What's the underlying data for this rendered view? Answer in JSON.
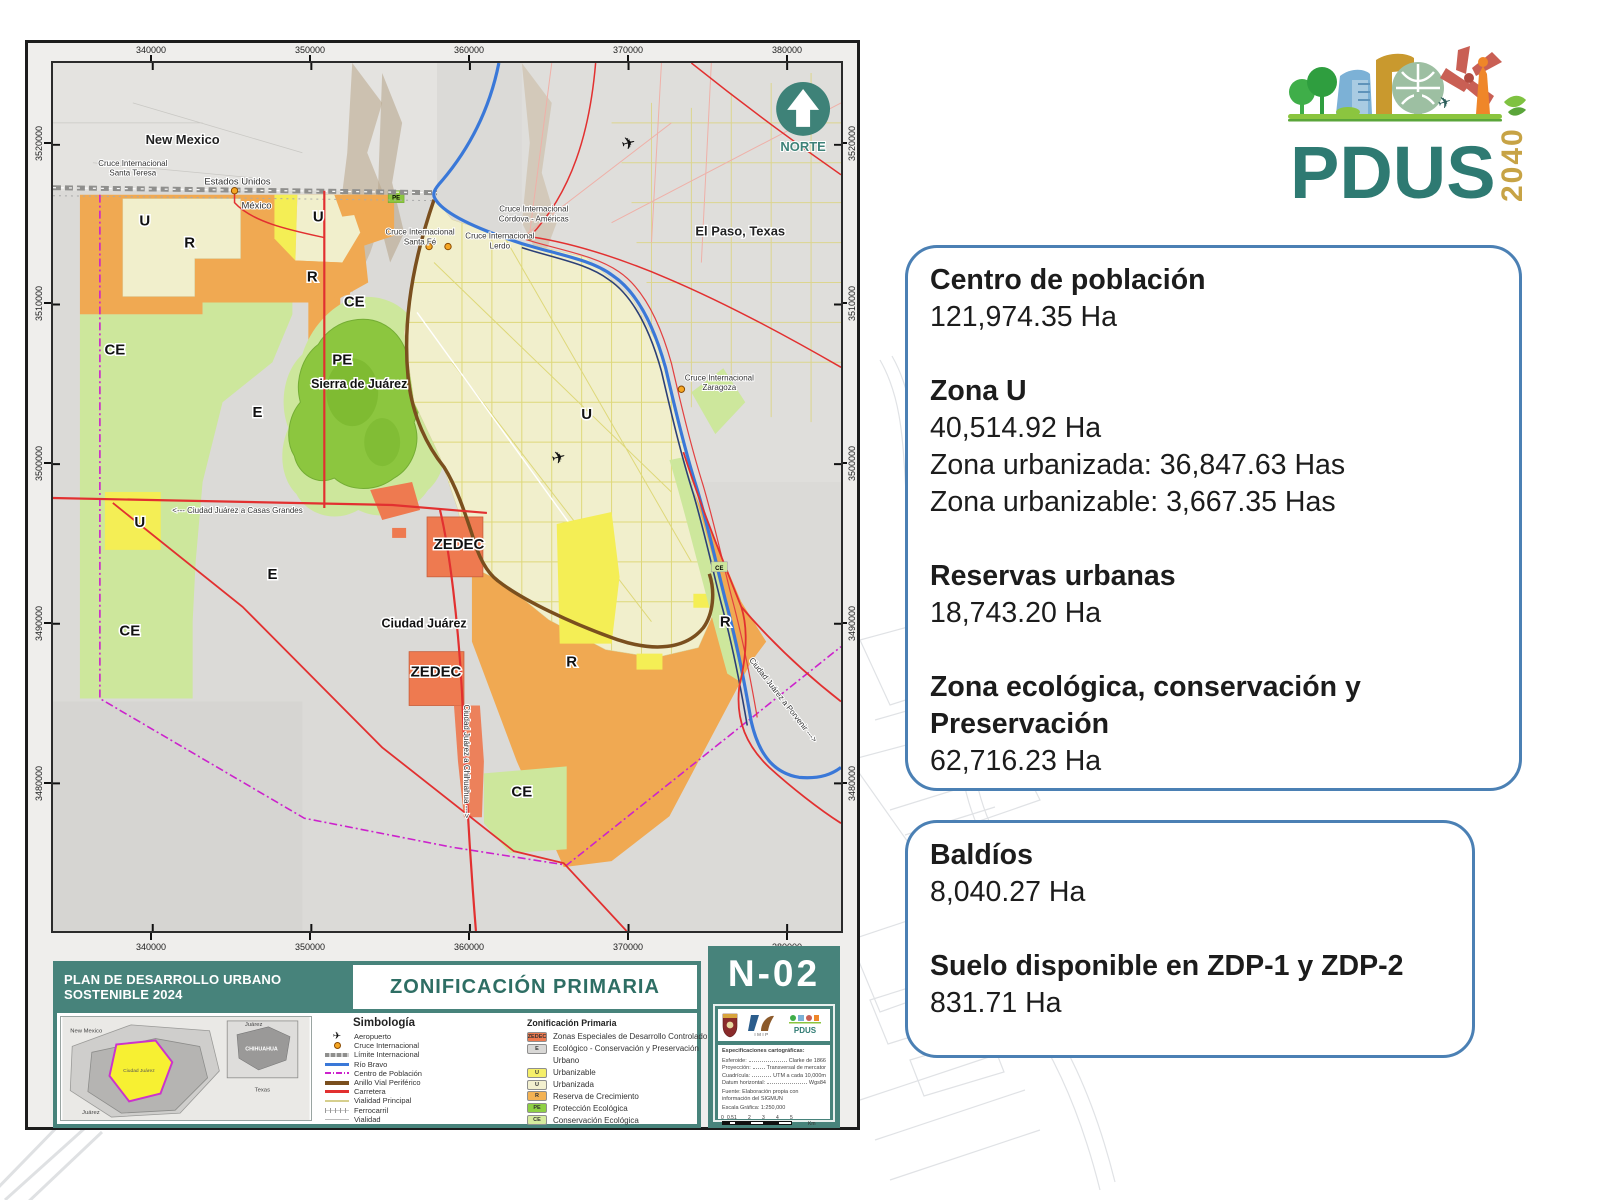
{
  "colors": {
    "teal": "#47837b",
    "teal_text": "#2e6e64",
    "panel_border": "#4b80b4",
    "zedec": "#ee7a50",
    "reserva": "#f0a952",
    "urbanizable": "#f4ee55",
    "urbanizada": "#f1efcc",
    "conservacion": "#cde79c",
    "proteccion": "#8cc63f",
    "ecologico": "#d9d8d6",
    "rio": "#3a78d8",
    "carretera": "#e23030",
    "anillo": "#7a4f1e",
    "centro_poblacion": "#cc22cc",
    "logo_teal": "#2e7a72",
    "logo_gold": "#c7a345"
  },
  "logo": {
    "name": "PDUS",
    "year": "2040"
  },
  "panel1": {
    "items": [
      {
        "h": "Centro de población",
        "v": "121,974.35 Ha"
      },
      {
        "h": "Zona U",
        "v": "40,514.92 Ha",
        "extra1": "Zona urbanizada: 36,847.63 Has",
        "extra2": "Zona urbanizable: 3,667.35 Has"
      },
      {
        "h": "Reservas urbanas",
        "v": "18,743.20 Ha"
      },
      {
        "h": "Zona ecológica, conservación y Preservación",
        "v": "62,716.23 Ha"
      }
    ]
  },
  "panel2": {
    "items": [
      {
        "h": "Baldíos",
        "v": "8,040.27 Ha"
      },
      {
        "h": "Suelo disponible en ZDP-1 y ZDP-2",
        "v": "831.71 Ha"
      }
    ]
  },
  "sheet": {
    "banner": "PLAN DE DESARROLLO URBANO SOSTENIBLE 2024",
    "title": "ZONIFICACIÓN PRIMARIA",
    "code": "N-02",
    "north": "NORTE",
    "x_ticks": [
      "340000",
      "350000",
      "360000",
      "370000",
      "380000"
    ],
    "y_ticks": [
      "3520000",
      "3510000",
      "3500000",
      "3490000",
      "3480000"
    ],
    "icons": {
      "airport": "✈"
    },
    "labels": {
      "new_mexico": "New Mexico",
      "el_paso": "El Paso, Texas",
      "estados_unidos": "Estados Unidos",
      "mexico": "México",
      "sierra": "Sierra de Juárez",
      "ciudad_juarez": "Ciudad Juárez",
      "u": "U",
      "r": "R",
      "ce": "CE",
      "pe": "PE",
      "e": "E",
      "zedec": "ZEDEC"
    },
    "crossings": {
      "l1": "Cruce Internacional",
      "santa_teresa": "Santa Teresa",
      "cordova": "Córdova - Américas",
      "santa_fe": "Santa Fé",
      "lerdo": "Lerdo",
      "zaragoza": "Zaragoza"
    },
    "roads": {
      "casas_grandes": "<--- Ciudad Juárez a Casas Grandes",
      "chihuahua": "Ciudad Juárez a Chihuahua --->",
      "porvenir": "Ciudad Juárez a Porvenir --->"
    },
    "inset": {
      "new_mexico": "New Mexico",
      "chihuahua": "CHIHUAHUA",
      "texas": "Texas",
      "juarez": "Juárez",
      "ciudad_juarez": "Ciudad Juárez"
    },
    "simbologia": {
      "title": "Simbología",
      "items": [
        "Aeropuerto",
        "Cruce Internacional",
        "Límite Internacional",
        "Río Bravo",
        "Centro de Población",
        "Anillo Vial Periférico",
        "Carretera",
        "Vialidad Principal",
        "Ferrocarril",
        "Vialidad"
      ]
    },
    "zonificacion": {
      "title": "Zonificación Primaria",
      "urbano": "Urbano",
      "items": [
        {
          "code": "ZEDEC",
          "color": "#ee7a50",
          "label": "Zonas Especiales de Desarrollo Controlado"
        },
        {
          "code": "E",
          "color": "#d9d8d6",
          "label": "Ecológico - Conservación y Preservación"
        },
        {
          "code": "U",
          "color": "#f5ef6a",
          "label": "Urbanizable"
        },
        {
          "code": "U",
          "color": "#f3f0cf",
          "label": "Urbanizada"
        },
        {
          "code": "R",
          "color": "#f3b254",
          "label": "Reserva de Crecimiento"
        },
        {
          "code": "PE",
          "color": "#8ed044",
          "label": "Protección Ecológica"
        },
        {
          "code": "CE",
          "color": "#d6eb9e",
          "label": "Conservación Ecológica"
        }
      ]
    },
    "specs": {
      "title": "Especificaciones cartográficas:",
      "rows": [
        {
          "k": "Esferoide:",
          "v": "Clarke de 1866"
        },
        {
          "k": "Proyección:",
          "v": "Transversal de mercator"
        },
        {
          "k": "Cuadrícula:",
          "v": "UTM a cada 10,000m"
        },
        {
          "k": "Datum horizontal:",
          "v": "Wgs84"
        }
      ],
      "fuente": "Fuente: Elaboración propia con información del SIGMUN",
      "escala": "Escala Gráfica: 1:250,000",
      "scale_ticks": [
        "0",
        "0.5",
        "1",
        "2",
        "3",
        "4",
        "5"
      ],
      "unit": "Km",
      "imip": "IMIP",
      "pdus_mini": "PDUS"
    }
  }
}
